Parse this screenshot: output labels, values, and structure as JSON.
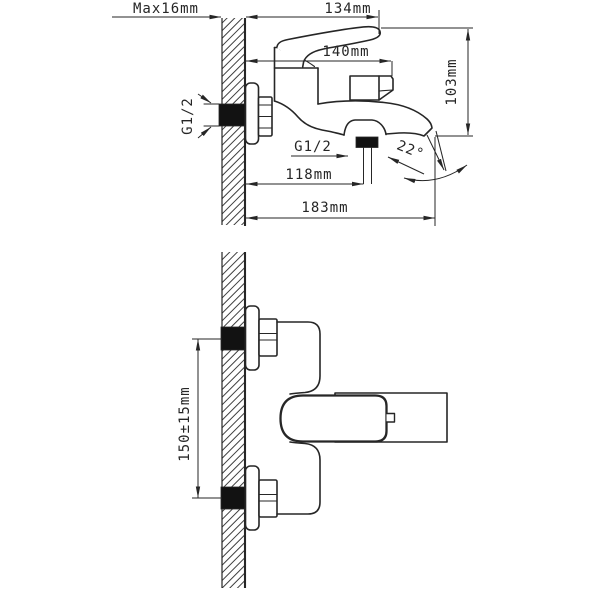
{
  "colors": {
    "line": "#262626",
    "black_fill": "#121212",
    "background": "#ffffff"
  },
  "side_view": {
    "labels": {
      "max_wall_thickness": "Max16mm",
      "dim_134": "134mm",
      "dim_140": "140mm",
      "dim_103": "103mm",
      "inlet_thread": "G1/2",
      "hose_thread": "G1/2",
      "dim_118": "118mm",
      "dim_183": "183mm",
      "spout_angle": "22°"
    }
  },
  "plan_view": {
    "labels": {
      "inlet_spacing": "150±15mm"
    }
  }
}
